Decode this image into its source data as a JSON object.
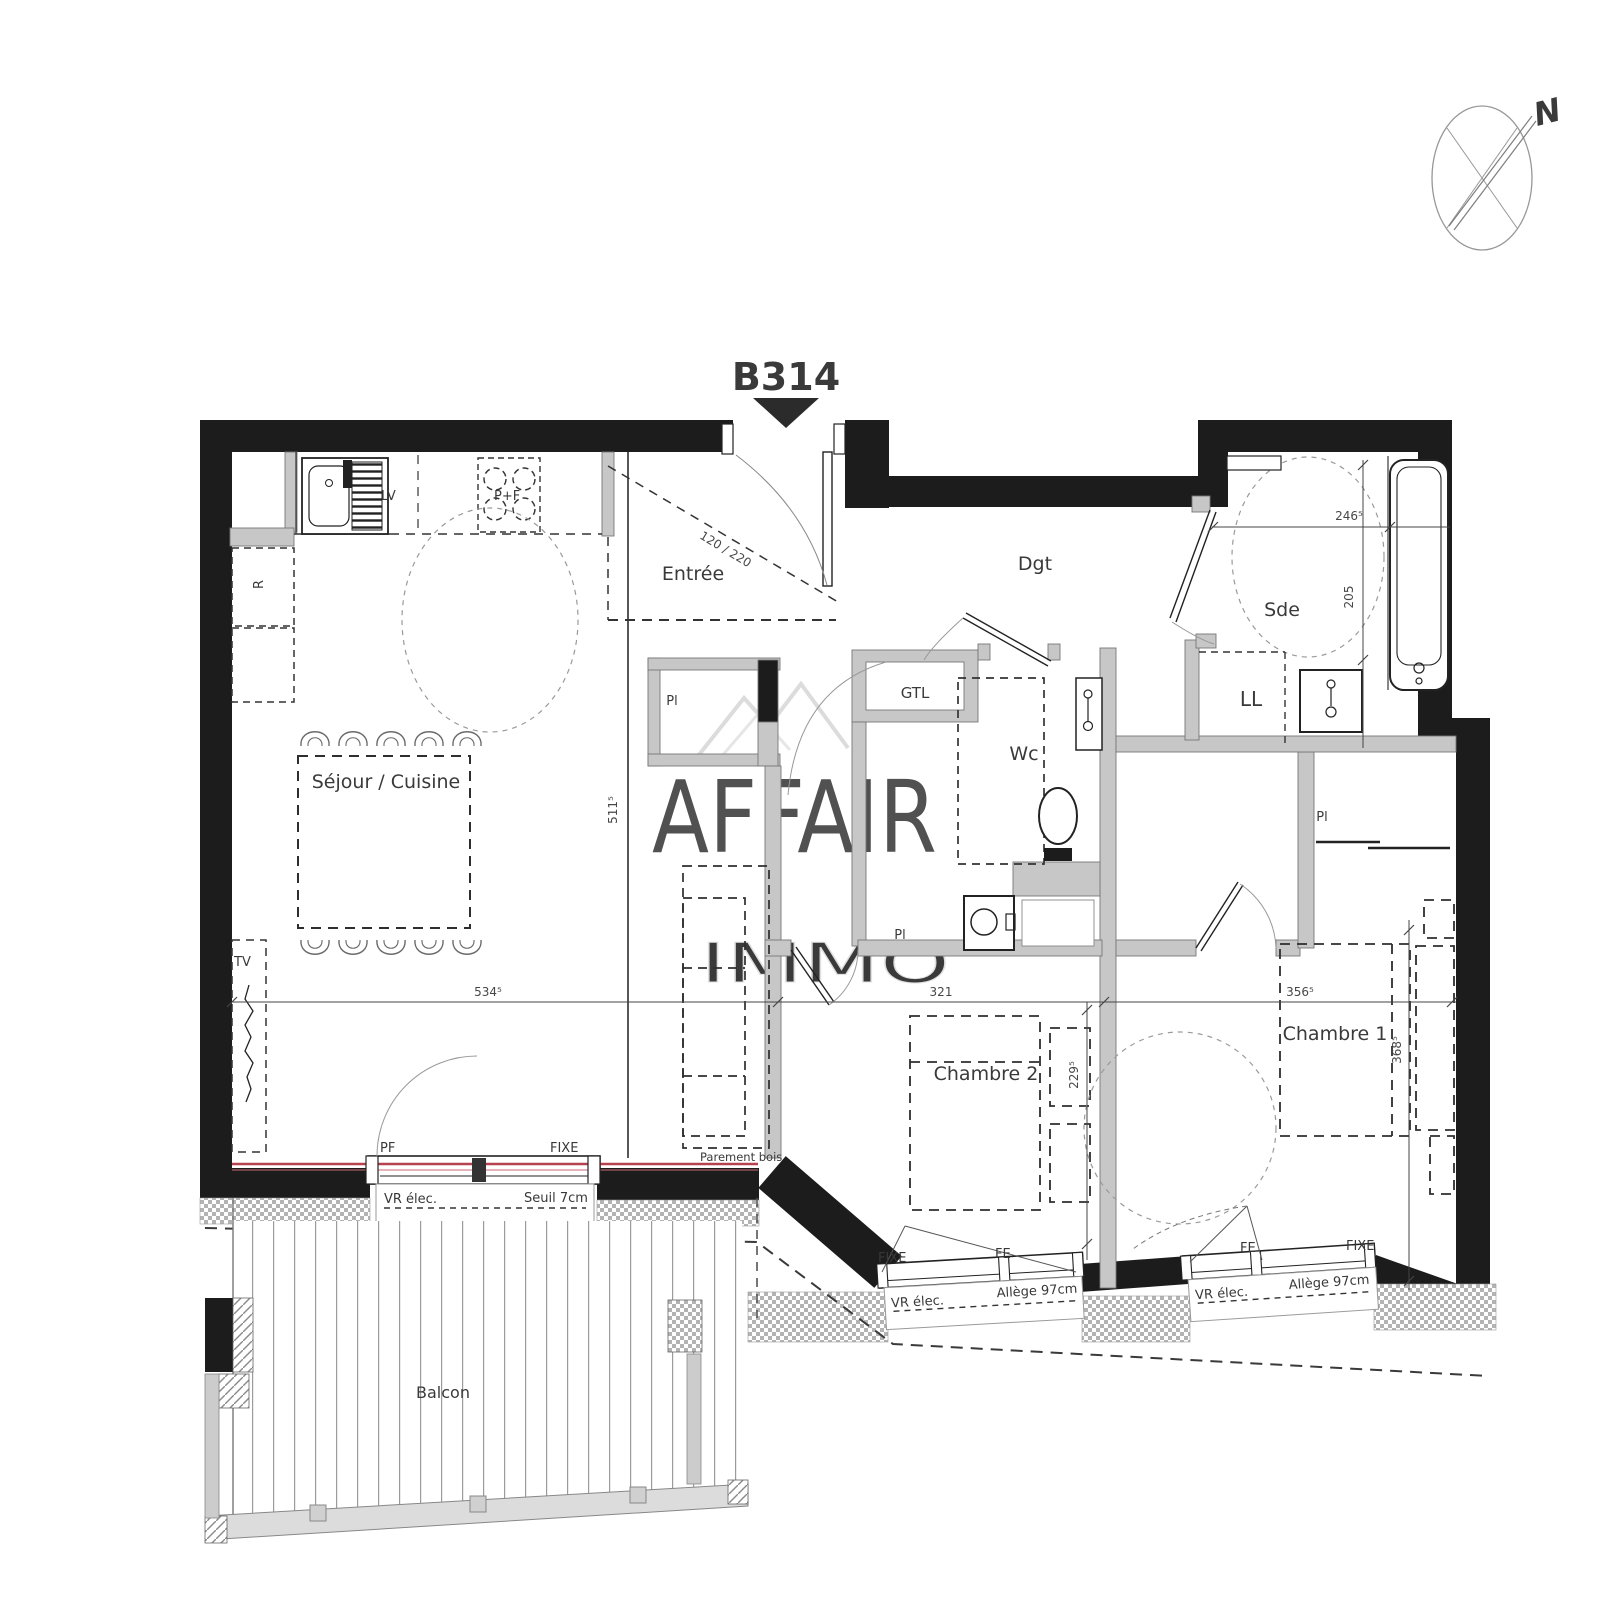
{
  "meta": {
    "plan_code": "B314",
    "north": "N"
  },
  "watermark": {
    "brand": "AFFAIR",
    "sub": "IMMO"
  },
  "rooms": {
    "sejour": "Séjour / Cuisine",
    "entree": "Entrée",
    "dgt": "Dgt",
    "sde": "Sde",
    "wc": "Wc",
    "ch1": "Chambre 1",
    "ch2": "Chambre 2",
    "balcon": "Balcon"
  },
  "fixtures": {
    "lv": "LV",
    "cooktop": "P+F",
    "fridge": "R",
    "gtl": "GTL",
    "ll": "LL",
    "tv": "TV",
    "pl": "Pl"
  },
  "openings": {
    "pf": "PF",
    "fixe": "FIXE",
    "fe": "FE",
    "vr_elec": "VR élec.",
    "seuil": "Seuil 7cm",
    "allege": "Allège 97cm",
    "parement": "Parement bois",
    "door_size": "120 / 220"
  },
  "dims": {
    "sejour_w": "534⁵",
    "sejour_h": "511⁵",
    "ch2_w": "321",
    "ch2_h": "229⁵",
    "ch1_w": "356⁵",
    "ch1_h": "368⁵",
    "sde_w": "246⁵",
    "sde_h": "205"
  },
  "colors": {
    "accent": "#c0394a",
    "wall": "#1c1c1c",
    "partition": "#c7c7c7"
  }
}
